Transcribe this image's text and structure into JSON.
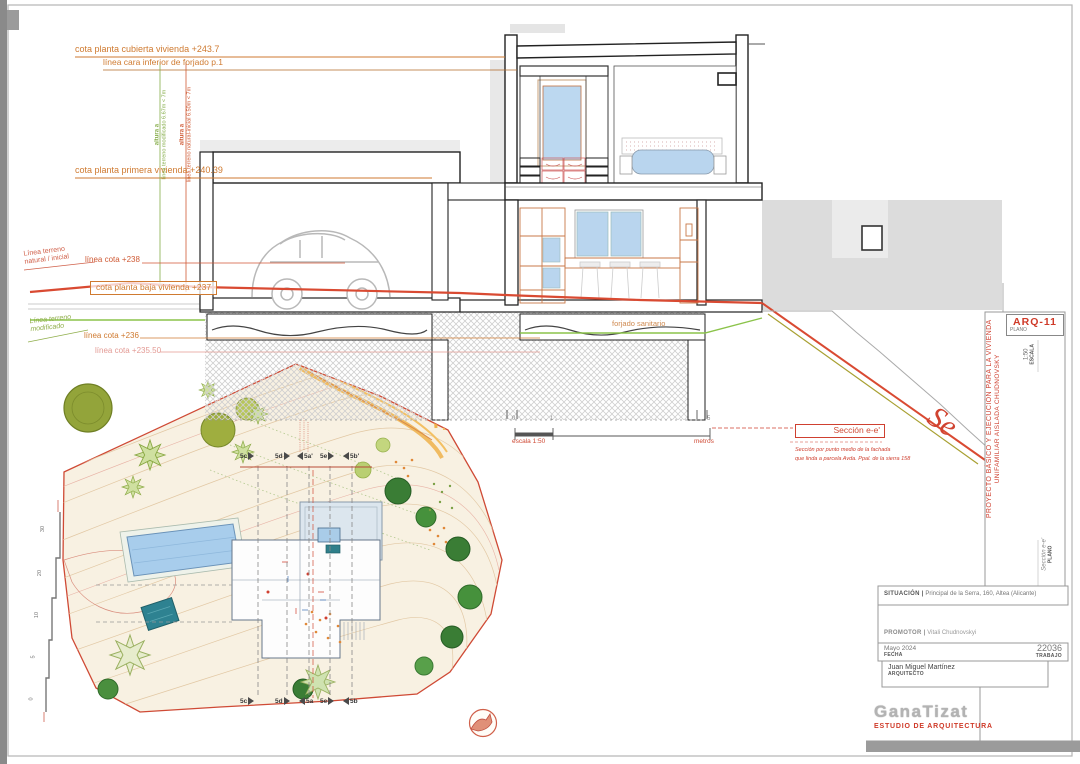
{
  "annotations": {
    "cota_cubierta": "cota planta cubierta vivienda +243.7",
    "linea_inferior": "línea cara inferior de forjado p.1",
    "cota_primera": "cota planta primera vivienda +240.39",
    "altura_mod_label": "altura a",
    "altura_mod_value": "línea terreno modificado 6.67m < 7m",
    "altura_nat_label": "altura a",
    "altura_nat_value": "línea terreno natural-inicial 6.50m < 7m",
    "terreno_natural_l1": "Línea terreno",
    "terreno_natural_l2": "natural / inicial",
    "linea_238": "línea cota +238",
    "cota_baja": "cota planta baja vivienda +237",
    "terreno_mod_l1": "Línea terreno",
    "terreno_mod_l2": "modificado",
    "linea_236": "línea cota +236",
    "linea_23550": "línea cota +235.50",
    "forjado_sanitario": "forjado sanitario"
  },
  "scalebar": {
    "t0": "0",
    "t1": "1",
    "t5": "5",
    "escala": "escala 1:50",
    "unit": "metros"
  },
  "section": {
    "title": "Sección e-e'",
    "note1": "Sección por punto medio de la fachada",
    "note2": "que linda a parcela Avda. Ppal. de la sierra 158",
    "big": "Se"
  },
  "titleblock_right": {
    "code": "ARQ-11",
    "code_sub": "PLANO",
    "escala_value": "1:50",
    "escala_label": "ESCALA",
    "project_line1": "PROYECTO BÁSICO Y EJECUCIÓN PARA LA VIVIENDA",
    "project_line2": "UNIFAMILIAR AISLADA CHUDNOVSKY",
    "plano_value": "Sección e-e'",
    "plano_label": "PLANO"
  },
  "titleblock_bottom": {
    "situacion_label": "SITUACIÓN |",
    "situacion_value": "Principal de la Serra, 160, Altea (Alicante)",
    "promotor_label": "PROMOTOR |",
    "promotor_value": "Vitali Chudnovskyi",
    "fecha_value": "Mayo 2024",
    "fecha_label": "FECHA",
    "trabajo_value": "22036",
    "trabajo_label": "TRABAJO",
    "arquitecto_value": "Juan Miguel Martínez",
    "arquitecto_label": "ARQUITECTO"
  },
  "logo": {
    "name": "GanaTizat",
    "tagline": "ESTUDIO DE ARQUITECTURA"
  },
  "siteplan": {
    "markers_top": [
      "5c",
      "5d",
      "5a'",
      "5e",
      "5b'"
    ],
    "markers_bottom": [
      "5c",
      "5d",
      "5a",
      "5e",
      "5b"
    ],
    "ruler": [
      "30",
      "20",
      "10",
      "5",
      "0"
    ]
  }
}
